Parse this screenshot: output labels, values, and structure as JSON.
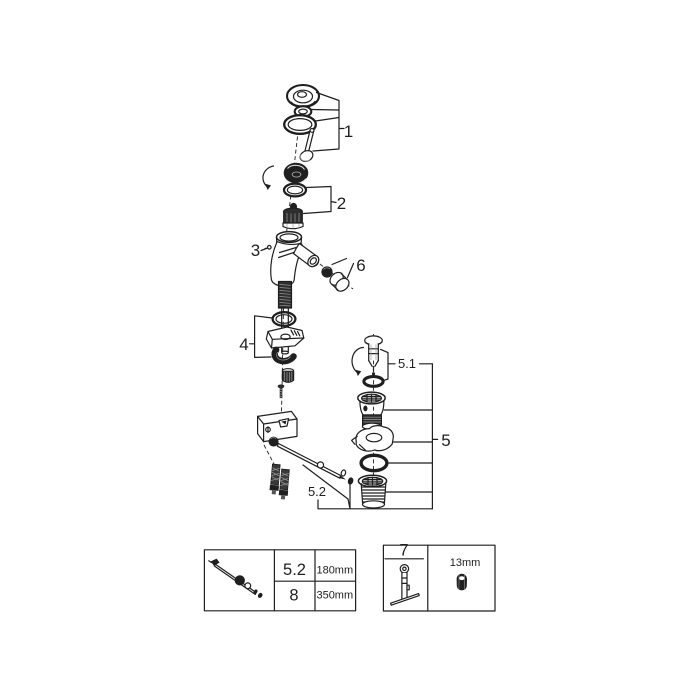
{
  "colors": {
    "line": "#1f1f1f",
    "background": "#ffffff"
  },
  "callouts": {
    "part1": "1",
    "part2": "2",
    "part3": "3",
    "part4": "4",
    "part5": "5",
    "part5_1": "5.1",
    "part5_2": "5.2",
    "part6": "6"
  },
  "spec_table": {
    "rows": [
      {
        "ref": "5.2",
        "length": "180mm"
      },
      {
        "ref": "8",
        "length": "350mm"
      }
    ]
  },
  "tool_box": {
    "ref": "7",
    "size": "13mm"
  }
}
